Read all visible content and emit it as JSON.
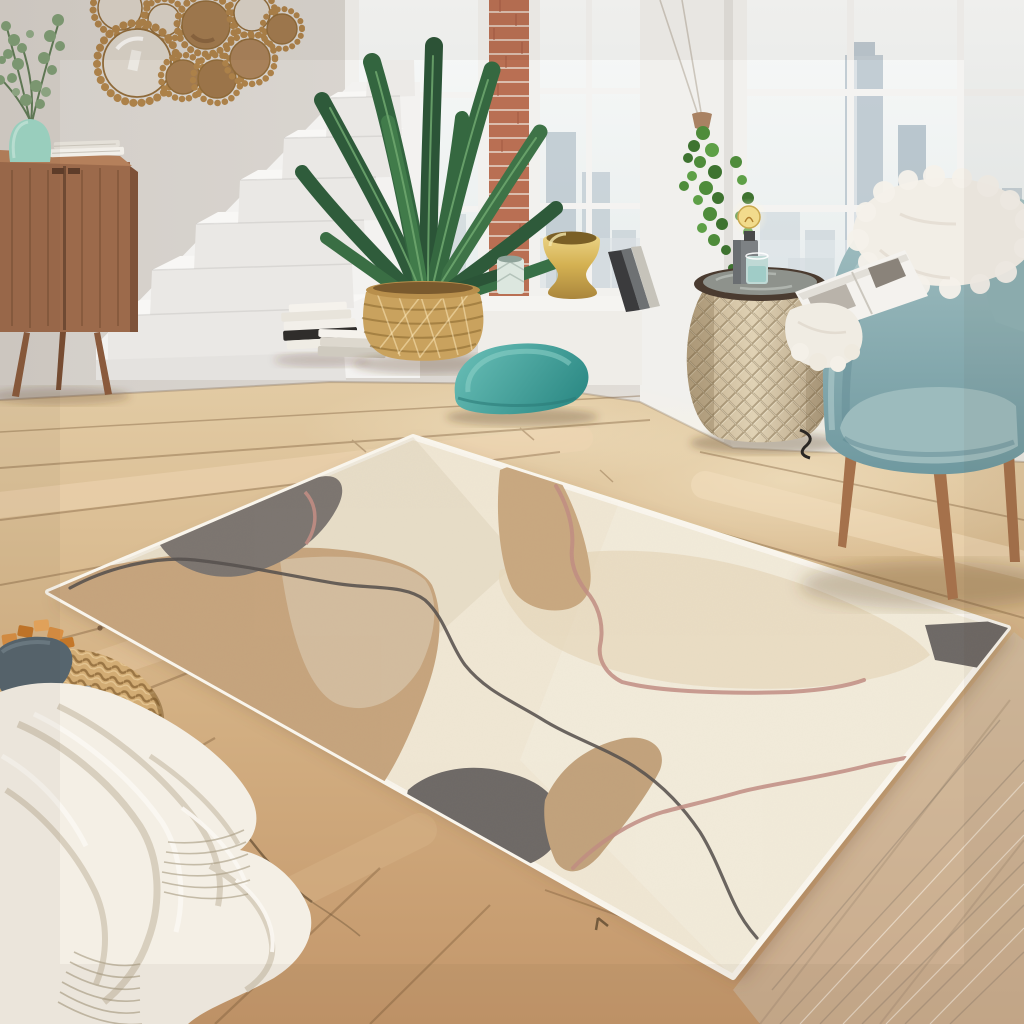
{
  "meta": {
    "title": "Bright loft living room with abstract beige area rug, teal armchair and white staircase",
    "image_type": "interior product photograph",
    "product": "Abstract pastel area rug in cream, sand, taupe, grey and blush"
  },
  "palette": {
    "wall": "#D6D1CB",
    "wallLight": "#EAE8E4",
    "sky": "#F5F7F6",
    "skyline": "#B3C0C9",
    "skylineFar": "#C9D3D9",
    "brick": "#B96F53",
    "mortar": "#E4D1C4",
    "windowFrame": "#F4F3F1",
    "stairWhite": "#F3F2F0",
    "stairFront": "#E7E5E2",
    "floorTop": "#DFC69E",
    "floorBottom": "#C89B6B",
    "seam": "#7A5A38",
    "mirrorGold": "#AC8149",
    "mirrorGlass": "#D7D0C6",
    "mirrorAmber": "#A17A4F",
    "sideboard": "#9C6A4B",
    "sideboardTop": "#B5805B",
    "legWood": "#8A5A3C",
    "vaseMint": "#9ED6C6",
    "leafDark": "#2E5A3A",
    "leafMid": "#3A7047",
    "leafVein": "#6FA86F",
    "eucalyptus": "#7E9B74",
    "basket": "#C9A25E",
    "basketDark": "#A67E41",
    "bookWhite": "#F2EFE9",
    "bookDark": "#2F2D2B",
    "ivyGreen": "#4F8C3B",
    "goldVase": "#D4B152",
    "candleMint": "#DCE7DF",
    "cushionTeal": "#47A6A2",
    "drumBody": "#D8C9AC",
    "drumRim": "#4A3B30",
    "lampBase": "#7D8184",
    "bulbGlow": "#F2DB8C",
    "glassWater": "#BFD9D5",
    "chairTeal": "#8FB3B6",
    "chairSeat": "#9CBBBD",
    "furWhite": "#F2EEE6",
    "woodLegChair": "#A5714B",
    "rugCream": "#F0E7D4",
    "rugEdge": "#F9F5EC",
    "rugTan": "#C6A47D",
    "rugTaupe": "#D6C2A6",
    "rugSand": "#E7D8BC",
    "rugGray": "#7C7570",
    "rugGrayDark": "#6E6966",
    "rugCharcoal": "#55504C",
    "rugPink": "#C18D83",
    "poufWicker": "#D2AC74",
    "poufDark": "#8A6434",
    "bowlSlate": "#56656E",
    "caramel": "#D98F43",
    "caramelDark": "#C47729",
    "caramelLight": "#E8A75D",
    "blanketWhite": "#F4EFE5",
    "blanketShadow": "#D6CCBA",
    "phoneGray": "#A7AFB3"
  },
  "scene": {
    "objects": [
      {
        "name": "area-rug",
        "description": "Large abstract rug, cream ground with sand and taupe organic shapes, charcoal and blush squiggle lines, grey patches, white bound edge"
      },
      {
        "name": "sunburst-mirrors",
        "description": "Cluster of nine round gold beaded wall mirrors"
      },
      {
        "name": "sideboard",
        "description": "Mid-century walnut sideboard with books and mint vase of eucalyptus"
      },
      {
        "name": "staircase",
        "description": "White minimalist stairs ascending to the right"
      },
      {
        "name": "potted-plant",
        "description": "Peace lily in woven belly basket"
      },
      {
        "name": "floor-books",
        "description": "Two small stacks of books at stair base"
      },
      {
        "name": "windows",
        "description": "White grid loft windows with hazy city skyline and brick pier"
      },
      {
        "name": "hanging-plant",
        "description": "Ivy in hanging planter by window pillar"
      },
      {
        "name": "sill-decor",
        "description": "Gold vase, mint candle holder and leaning books on window ledge"
      },
      {
        "name": "floor-cushion",
        "description": "Teal velvet floor cushion"
      },
      {
        "name": "drum-side-table",
        "description": "Perforated champagne metal drum table with edison lamp and water glass"
      },
      {
        "name": "armchair",
        "description": "Dusty teal armchair, wooden tapered legs, white fur pillow and open magazine"
      },
      {
        "name": "pouf",
        "description": "Rattan pouf with slate bowl of caramel cubes and a phone"
      },
      {
        "name": "throw-blanket",
        "description": "Cream knit throw draped from pouf onto oak floor"
      }
    ]
  }
}
